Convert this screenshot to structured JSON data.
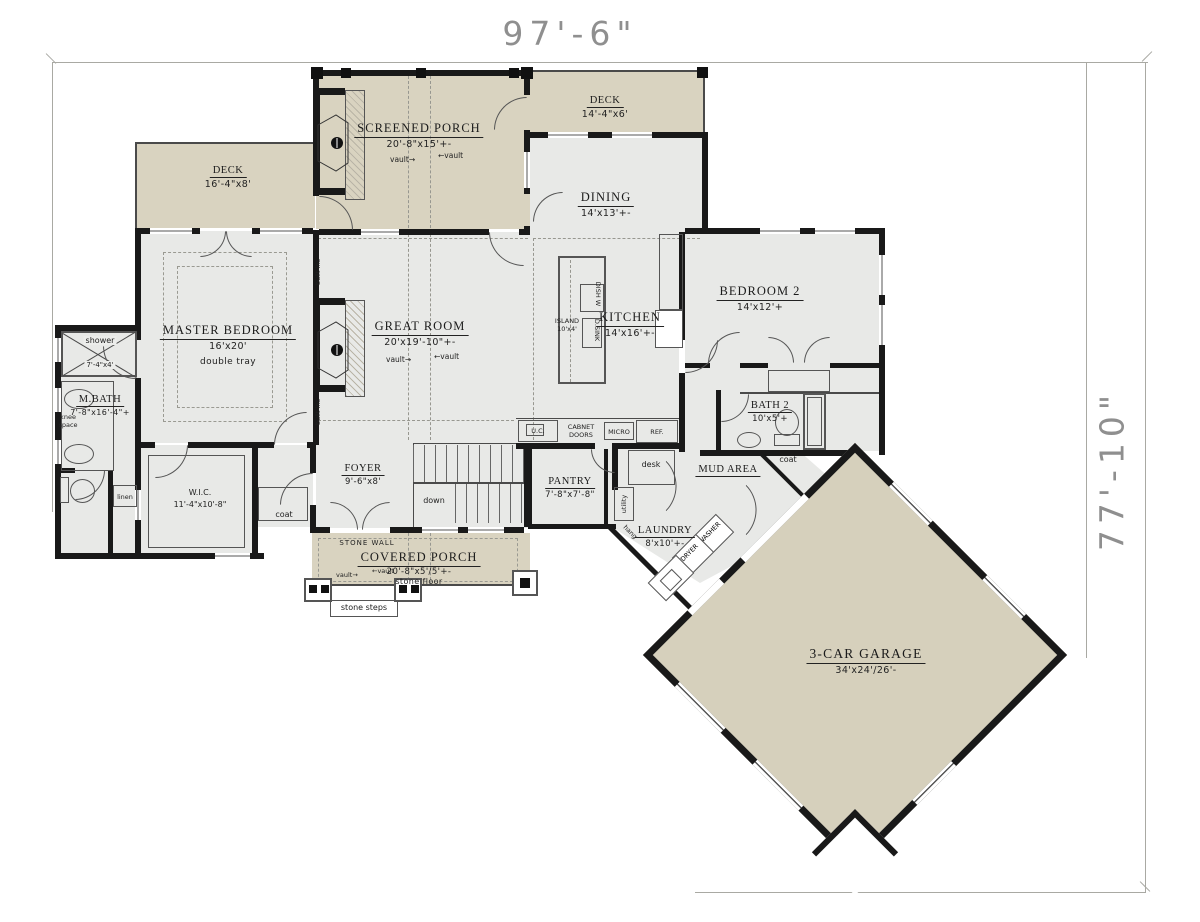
{
  "plan": {
    "overall_width": "97'-6\"",
    "overall_height": "77'-10\"",
    "rooms": {
      "screened_porch": {
        "name": "SCREENED PORCH",
        "size": "20'-8\"x15'+-"
      },
      "deck_top": {
        "name": "DECK",
        "size": "14'-4\"x6'"
      },
      "deck_left": {
        "name": "DECK",
        "size": "16'-4\"x8'"
      },
      "dining": {
        "name": "DINING",
        "size": "14'x13'+-"
      },
      "master_bedroom": {
        "name": "MASTER BEDROOM",
        "size": "16'x20'",
        "note": "double tray"
      },
      "great_room": {
        "name": "GREAT ROOM",
        "size": "20'x19'-10\"+-"
      },
      "kitchen": {
        "name": "KITCHEN",
        "size": "14'x16'+-"
      },
      "bedroom_2": {
        "name": "BEDROOM 2",
        "size": "14'x12'+"
      },
      "master_bath": {
        "name": "M.BATH",
        "size": "7'-8\"x16'-4\"+"
      },
      "bath_2": {
        "name": "BATH 2",
        "size": "10'x5'+"
      },
      "wic": {
        "name": "W.I.C.",
        "size": "11'-4\"x10'-8\""
      },
      "foyer": {
        "name": "FOYER",
        "size": "9'-6\"x8'"
      },
      "pantry": {
        "name": "PANTRY",
        "size": "7'-8\"x7'-8\""
      },
      "laundry": {
        "name": "LAUNDRY",
        "size": "8'x10'+-"
      },
      "mud_area": {
        "name": "MUD AREA"
      },
      "covered_porch": {
        "name": "COVERED PORCH",
        "size": "20'-8\"x5'/5'+-",
        "floor": "stone floor"
      },
      "garage": {
        "name": "3-CAR GARAGE",
        "size": "34'x24'/26'-"
      },
      "shower": {
        "name": "shower",
        "size": "7'-4\"x4'"
      }
    },
    "labels": {
      "vault": "vault",
      "arrow_right": "→",
      "arrow_left": "←",
      "built_ins": "built-ins",
      "down": "down",
      "desk": "desk",
      "coat": "coat",
      "linen": "linen",
      "knee_1": "knee",
      "knee_2": "space",
      "utility": "utility",
      "hang": "hang",
      "washer": "WASHER",
      "dryer": "DRYER",
      "stone_wall": "STONE WALL",
      "stone_steps": "stone steps",
      "uc": "U.C.",
      "cabinet_1": "CABNET",
      "cabinet_2": "DOORS",
      "micro": "MICRO",
      "ref": "REF.",
      "island_1": "ISLAND",
      "island_2": "10'x4'",
      "dish_w": "DISH W",
      "d_sink": "D.SINK"
    },
    "colors": {
      "outdoor_fill": "#d9d3c0",
      "indoor_fill": "#e8e9e7",
      "wall": "#191919"
    }
  }
}
